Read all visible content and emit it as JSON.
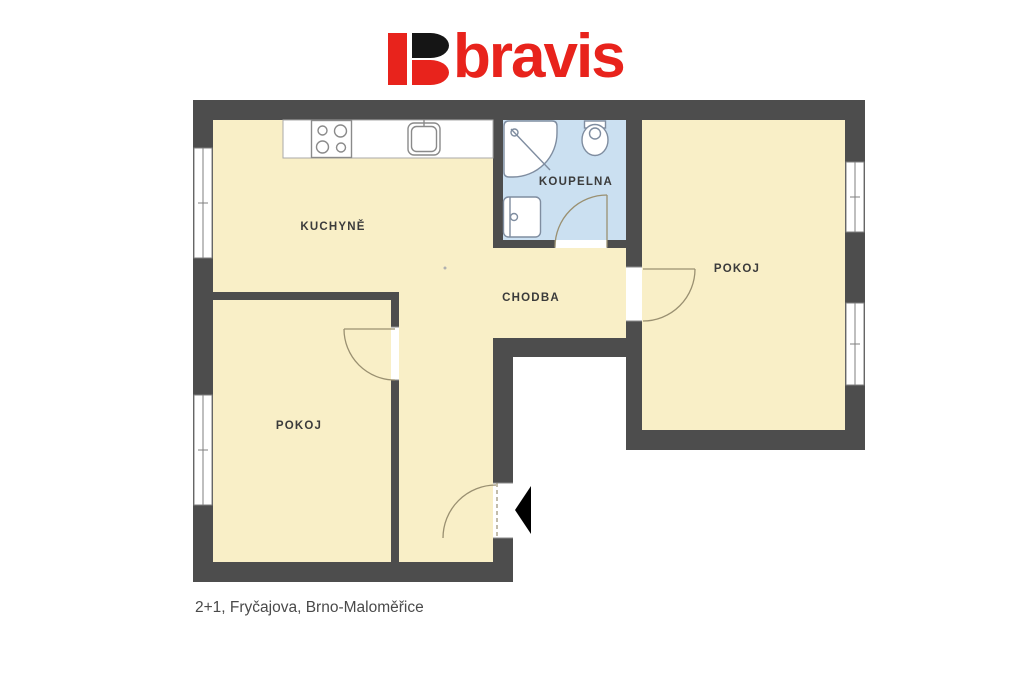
{
  "logo": {
    "wordmark": "bravis",
    "brand_red": "#e8231c",
    "brand_black": "#151515"
  },
  "plan": {
    "room_labels": {
      "kitchen": "KUCHYNĚ",
      "bathroom": "KOUPELNA",
      "hallway": "CHODBA",
      "room_right": "POKOJ",
      "room_left": "POKOJ"
    },
    "colors": {
      "wall": "#4d4d4d",
      "floor": "#f9efc7",
      "bathroom_floor": "#cbe0f1",
      "label_text": "#3b3b3b",
      "door_arc": "#9a9071",
      "entrance_arrow": "#000000"
    },
    "fixtures": [
      "stove",
      "kitchen-sink",
      "kitchen-counter",
      "shower",
      "toilet",
      "bathroom-sink"
    ],
    "doors": [
      "left-room-door",
      "right-room-door",
      "bathroom-door",
      "entrance-door"
    ],
    "windows_count": 4
  },
  "caption": {
    "text": "2+1, Fryčajova, Brno-Maloměřice"
  }
}
